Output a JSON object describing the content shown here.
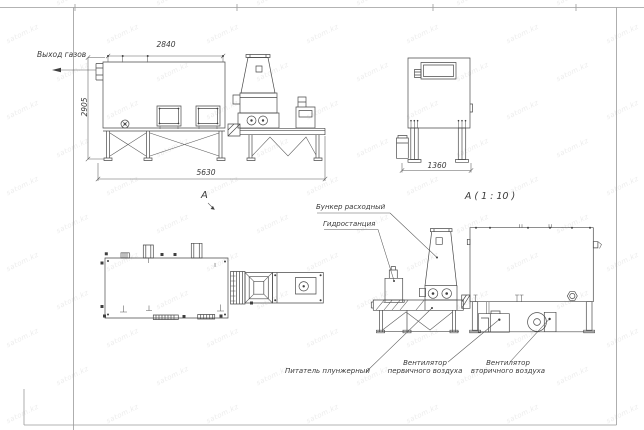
{
  "sheet": {
    "watermark_text": "satom.kz"
  },
  "front_view": {
    "gas_outlet_label": "Выход газов",
    "view_marker": "А",
    "dim_top": "2840",
    "dim_left": "2905",
    "dim_bottom": "5630"
  },
  "side_view": {
    "dim_bottom": "1360"
  },
  "detail_view": {
    "title": "А ( 1 : 10 )",
    "callout_hopper": "Бункер расходный",
    "callout_hydraulic": "Гидростанция",
    "callout_feeder": "Питатель плунжерный",
    "callout_primary_fan": "Вентилятор первичного воздуха",
    "callout_secondary_fan": "Вентилятор вторичного воздуха"
  }
}
